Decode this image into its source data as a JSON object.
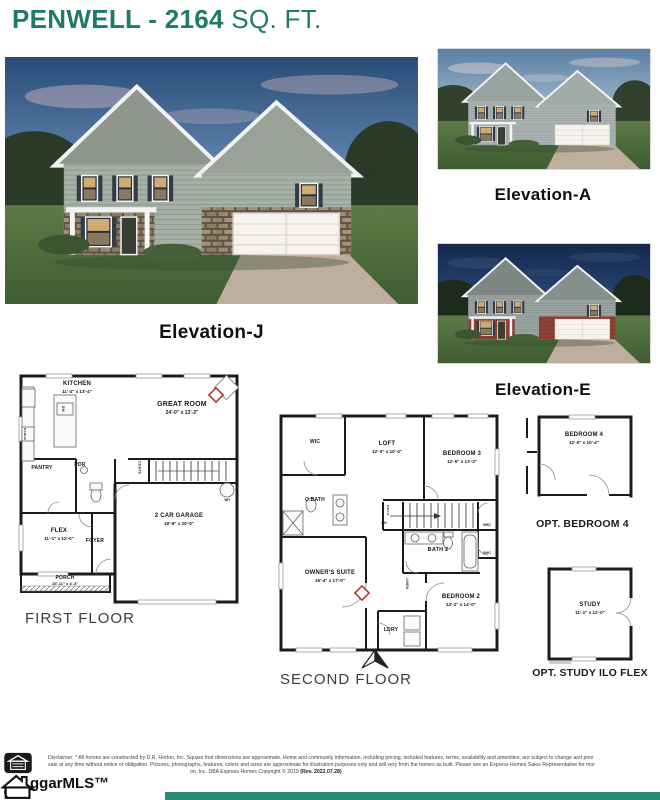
{
  "page": {
    "title_main": "PENWELL - 2164",
    "title_suffix": " SQ. FT.",
    "accent_color": "#1E7B6A",
    "footer_bar_color": "#2B8A73"
  },
  "photos": {
    "main": {
      "label": "Elevation-J"
    },
    "top_right": {
      "label": "Elevation-A"
    },
    "bottom_right": {
      "label": "Elevation-E"
    }
  },
  "first_floor": {
    "caption": "FIRST FLOOR",
    "rooms": {
      "kitchen": {
        "name": "KITCHEN",
        "dims": "11'-4\" x 13'-4\""
      },
      "great_room": {
        "name": "GREAT ROOM",
        "dims": "24'-0\" x 13'-3\""
      },
      "pantry": {
        "name": "PANTRY"
      },
      "pdr": {
        "name": "PDR"
      },
      "flex": {
        "name": "FLEX",
        "dims": "11'-1\" x 12'-0\""
      },
      "foyer": {
        "name": "FOYER"
      },
      "garage": {
        "name": "2 CAR GARAGE",
        "dims": "19'-9\" x 20'-0\""
      },
      "porch": {
        "name": "PORCH",
        "dims": "15'-11\" x 4'-3\""
      },
      "coats": {
        "name": "COATS"
      },
      "wh": {
        "name": "WH"
      },
      "dw": {
        "name": "DW"
      },
      "range": {
        "name": "RANGE"
      }
    }
  },
  "second_floor": {
    "caption": "SECOND FLOOR",
    "rooms": {
      "wic_owner": {
        "name": "WIC"
      },
      "loft": {
        "name": "LOFT",
        "dims": "12'-0\" x 10'-4\""
      },
      "bedroom3": {
        "name": "BEDROOM 3",
        "dims": "12'-5\" x 13'-3\""
      },
      "obath": {
        "name": "O.BATH"
      },
      "mech": {
        "name": "MECH"
      },
      "dn": {
        "name": "DN"
      },
      "wic_hall": {
        "name": "WIC"
      },
      "wic_bed2": {
        "name": "WIC"
      },
      "bath2": {
        "name": "BATH 2"
      },
      "owners_suite": {
        "name": "OWNER'S SUITE",
        "dims": "15'-4\" x 17'-0\""
      },
      "bedroom2": {
        "name": "BEDROOM 2",
        "dims": "13'-2\" x 14'-0\""
      },
      "ldry": {
        "name": "LDRY"
      },
      "linen": {
        "name": "LINEN"
      }
    }
  },
  "options": {
    "bedroom4": {
      "name": "BEDROOM 4",
      "dims": "12'-0\" x 10'-4\"",
      "caption": "OPT. BEDROOM 4"
    },
    "study": {
      "name": "STUDY",
      "dims": "11'-1\" x 12'-0\"",
      "caption": "OPT. STUDY ILO FLEX"
    }
  },
  "footer": {
    "disclaimer_line1": "Disclaimer: * All homes are constructed by D.R. Horton, Inc. Square foot dimensions are approximate. Home and community information, including pricing, included features, terms, availability and amenities, are subject to change and prior",
    "disclaimer_line2": "sale at any time without notice or obligation. Pictures, photographs, features, colors and sizes are approximate for illustration purposes only and will very from the homes as built. Please see an Express Homes Sales Representative for mor",
    "disclaimer_line3": "on, Inc. DBA Express Homes Copyright © 2019 ",
    "disclaimer_line3_rev": "(Rev. 2022.07.28)",
    "logo_text": "ggarMLS™"
  }
}
